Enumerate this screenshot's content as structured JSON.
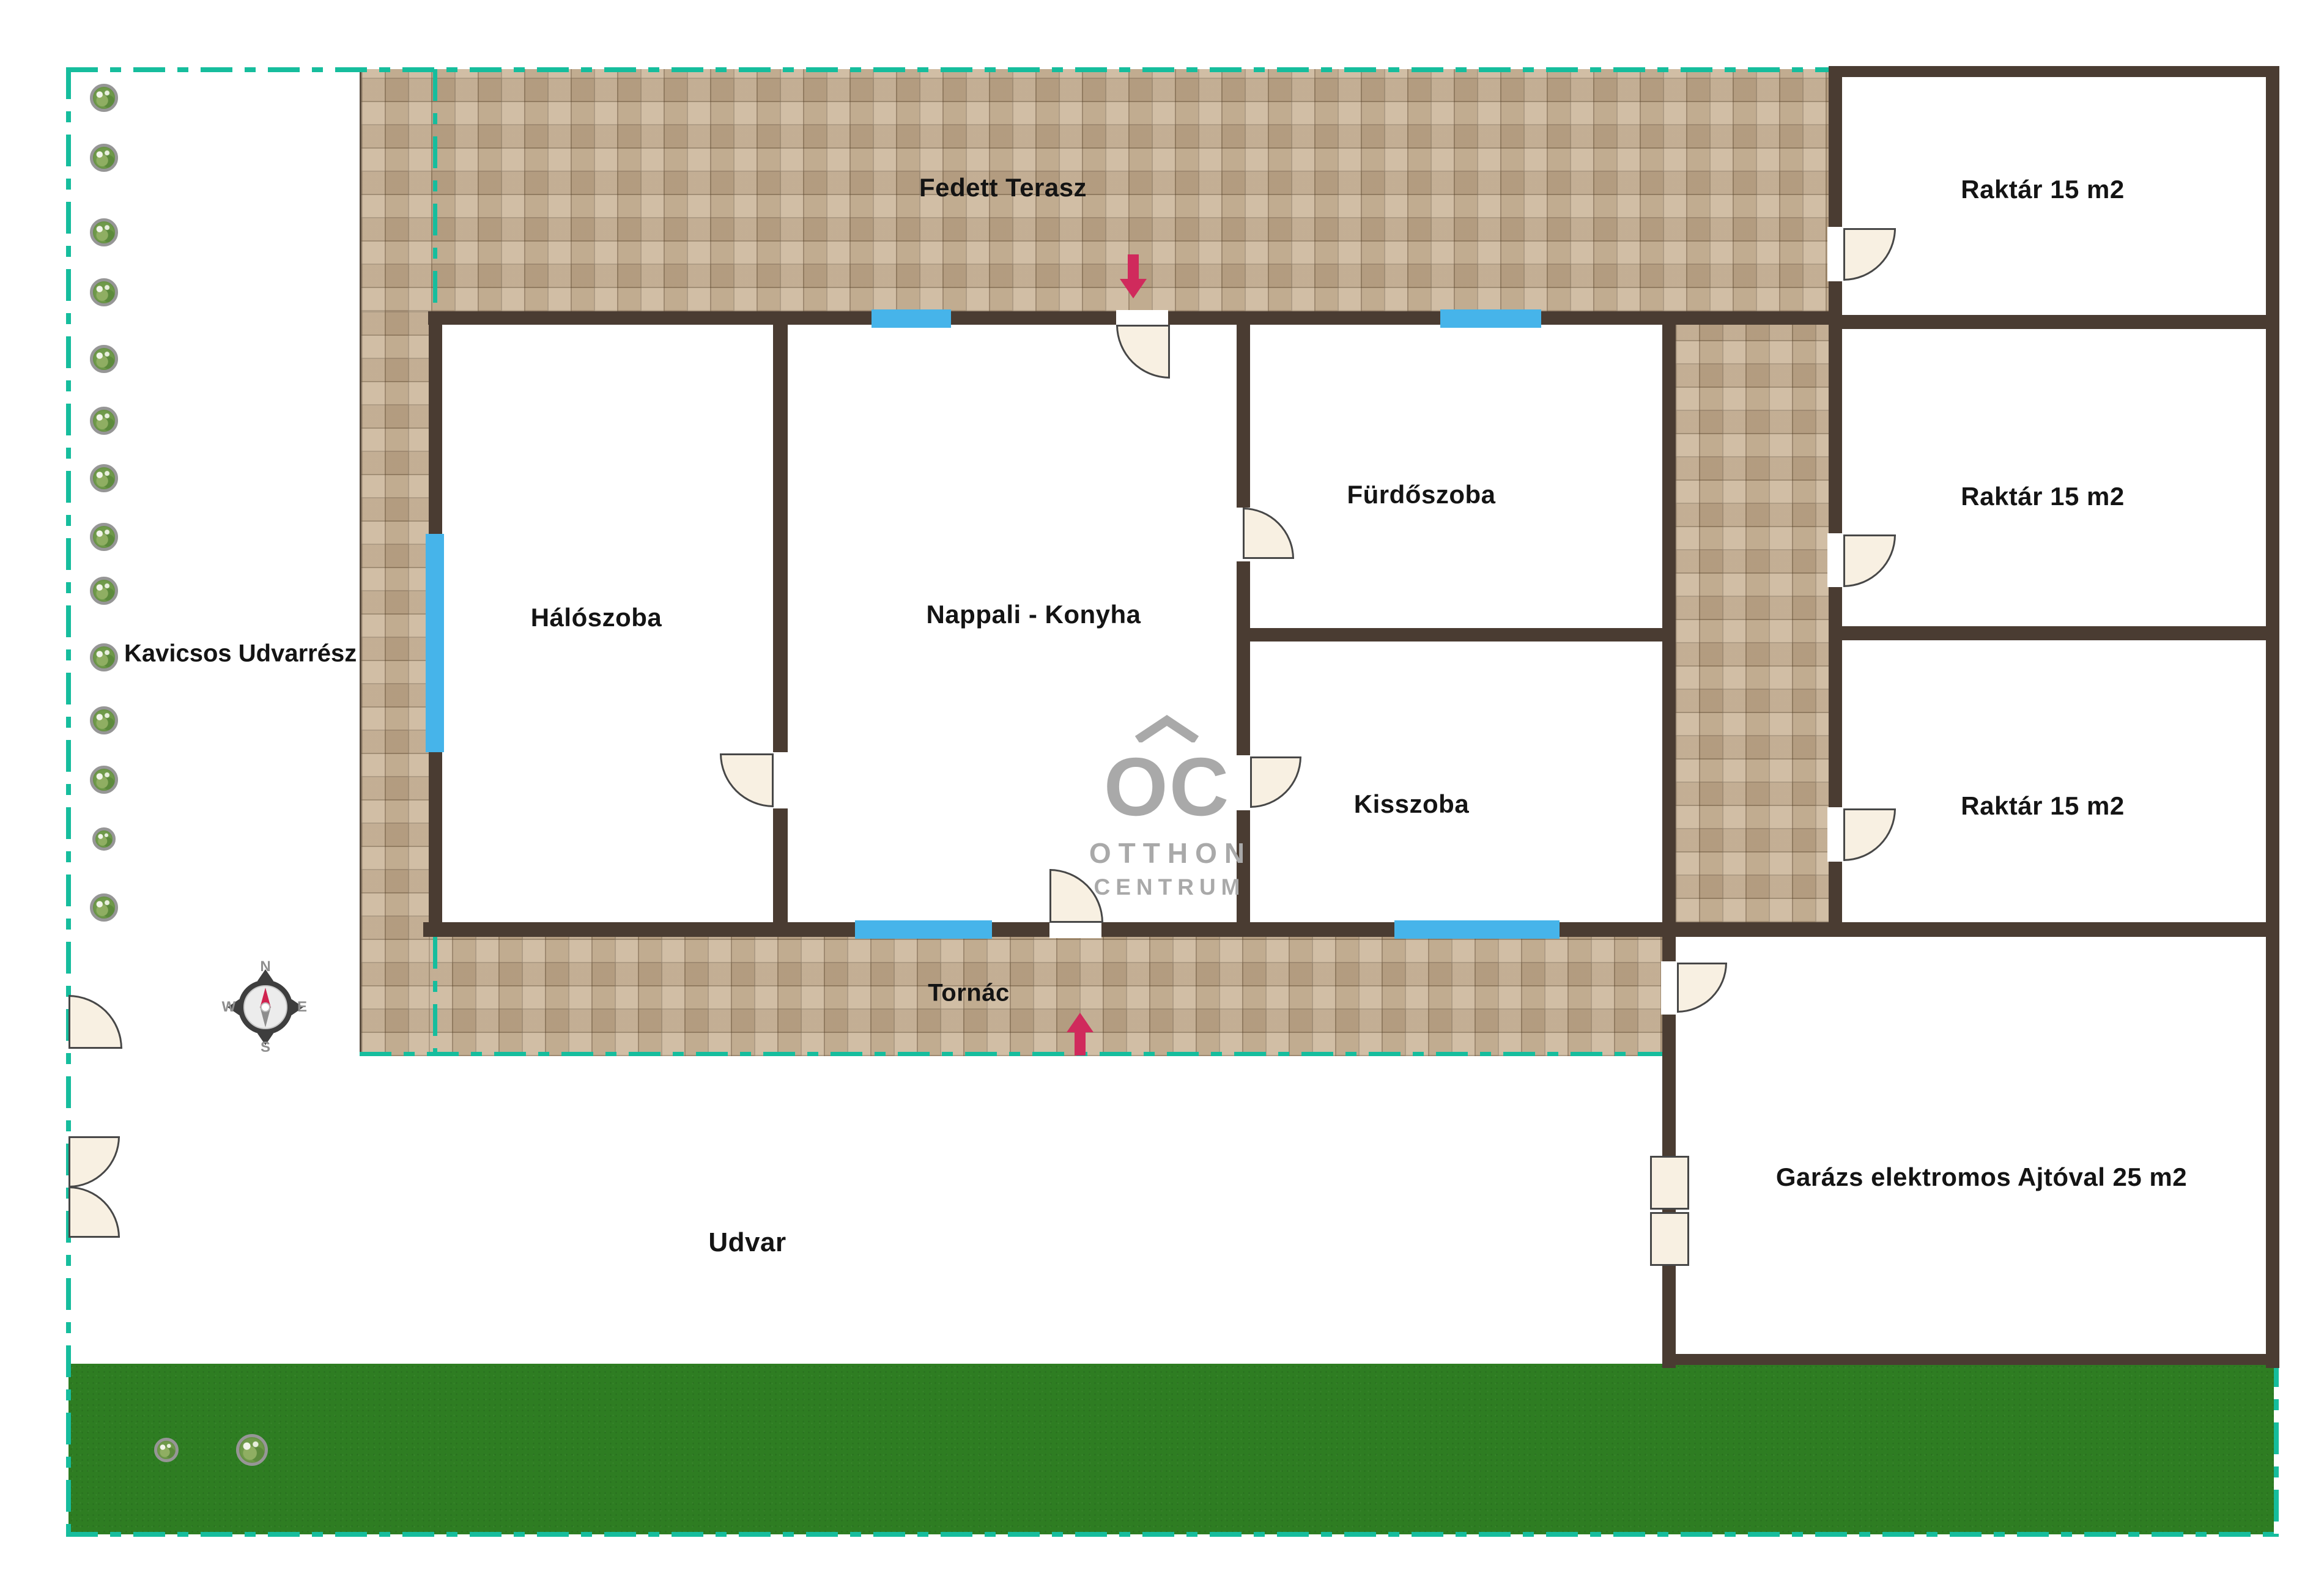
{
  "plan": {
    "labels": {
      "covered_terrace": "Fedett Terasz",
      "storage1": "Raktár 15 m2",
      "storage2": "Raktár 15 m2",
      "storage3": "Raktár 15 m2",
      "bedroom": "Hálószoba",
      "living_kitchen": "Nappali - Konyha",
      "bathroom": "Fürdőszoba",
      "small_room": "Kisszoba",
      "porch": "Tornác",
      "yard": "Udvar",
      "gravel_yard": "Kavicsos Udvarrész",
      "garage": "Garázs elektromos Ajtóval 25 m2"
    },
    "compass": {
      "n": "N",
      "e": "E",
      "s": "S",
      "w": "W"
    },
    "logo": {
      "monogram": "OC",
      "line1": "OTTHON",
      "line2": "CENTRUM"
    },
    "colors": {
      "boundary_teal": "#16bd9d",
      "wall_brown": "#4a3c32",
      "window_blue": "#46b4ea",
      "arrow_red": "#d02a5c",
      "grass_green": "#2e7d22",
      "tile_beige": "#c8b193",
      "logo_gray": "#a9a9a9",
      "door_leaf": "#f8f0e2"
    }
  }
}
